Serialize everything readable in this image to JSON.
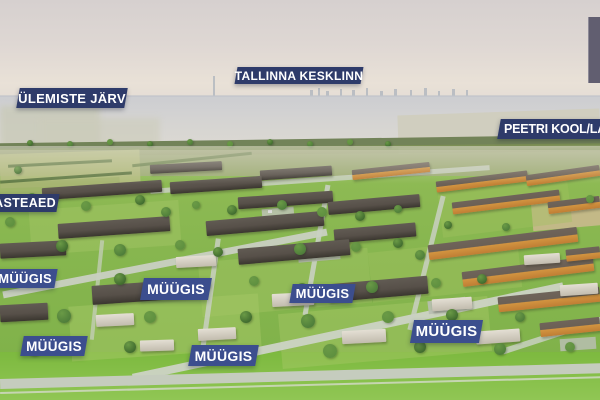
{
  "overlay": {
    "place_labels": [
      {
        "id": "ulemiste-jarv",
        "text": "ÜLEMISTE JÄRV"
      },
      {
        "id": "tallinna-kesklinn",
        "text": "TALLINNA KESKLINN"
      },
      {
        "id": "peetri-kool-lasteaed",
        "text": "PEETRI KOOL/LAS"
      },
      {
        "id": "lasteaed",
        "text": "ASTEAED"
      }
    ],
    "sale_labels": [
      {
        "id": "muugis-1",
        "text": "MÜÜGIS"
      },
      {
        "id": "muugis-2",
        "text": "MÜÜGIS"
      },
      {
        "id": "muugis-3",
        "text": "MÜÜGIS"
      },
      {
        "id": "muugis-4",
        "text": "MÜÜGIS"
      },
      {
        "id": "muugis-5",
        "text": "MÜÜGIS"
      },
      {
        "id": "muugis-6",
        "text": "MÜÜGIS"
      }
    ],
    "colors": {
      "place_label_bg": "#2e3b6a",
      "sale_label_bg": "#3c4e8e",
      "label_text": "#ffffff",
      "corner_overlay": "#615e70"
    }
  }
}
